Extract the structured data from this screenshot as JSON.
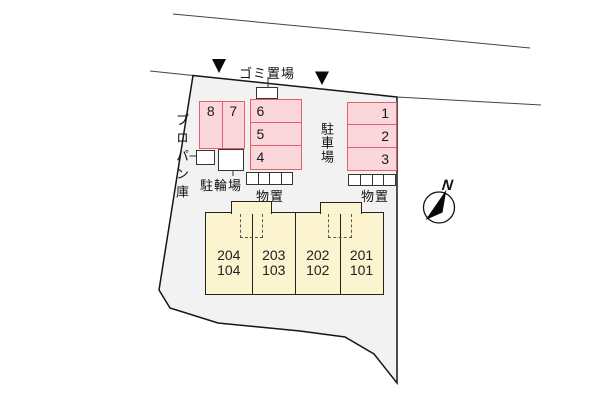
{
  "labels": {
    "garbage_area": "ゴミ置場",
    "propane_storage": "プロパン庫",
    "bicycle_parking": "駐輪場",
    "parking_lot": "駐車場",
    "storage_left": "物置",
    "storage_right": "物置",
    "north": "N"
  },
  "parking_stalls": {
    "left_group": [
      "8",
      "7"
    ],
    "middle_group": [
      "6",
      "5",
      "4"
    ],
    "right_group": [
      "1",
      "2",
      "3"
    ]
  },
  "building_units": [
    {
      "upper": "204",
      "lower": "104"
    },
    {
      "upper": "203",
      "lower": "103"
    },
    {
      "upper": "202",
      "lower": "102"
    },
    {
      "upper": "201",
      "lower": "101"
    }
  ],
  "colors": {
    "site_fill": "#f2f2f2",
    "stall_fill": "#fbd6da",
    "stall_border": "#e2606e",
    "building_fill": "#fcf4cf"
  }
}
